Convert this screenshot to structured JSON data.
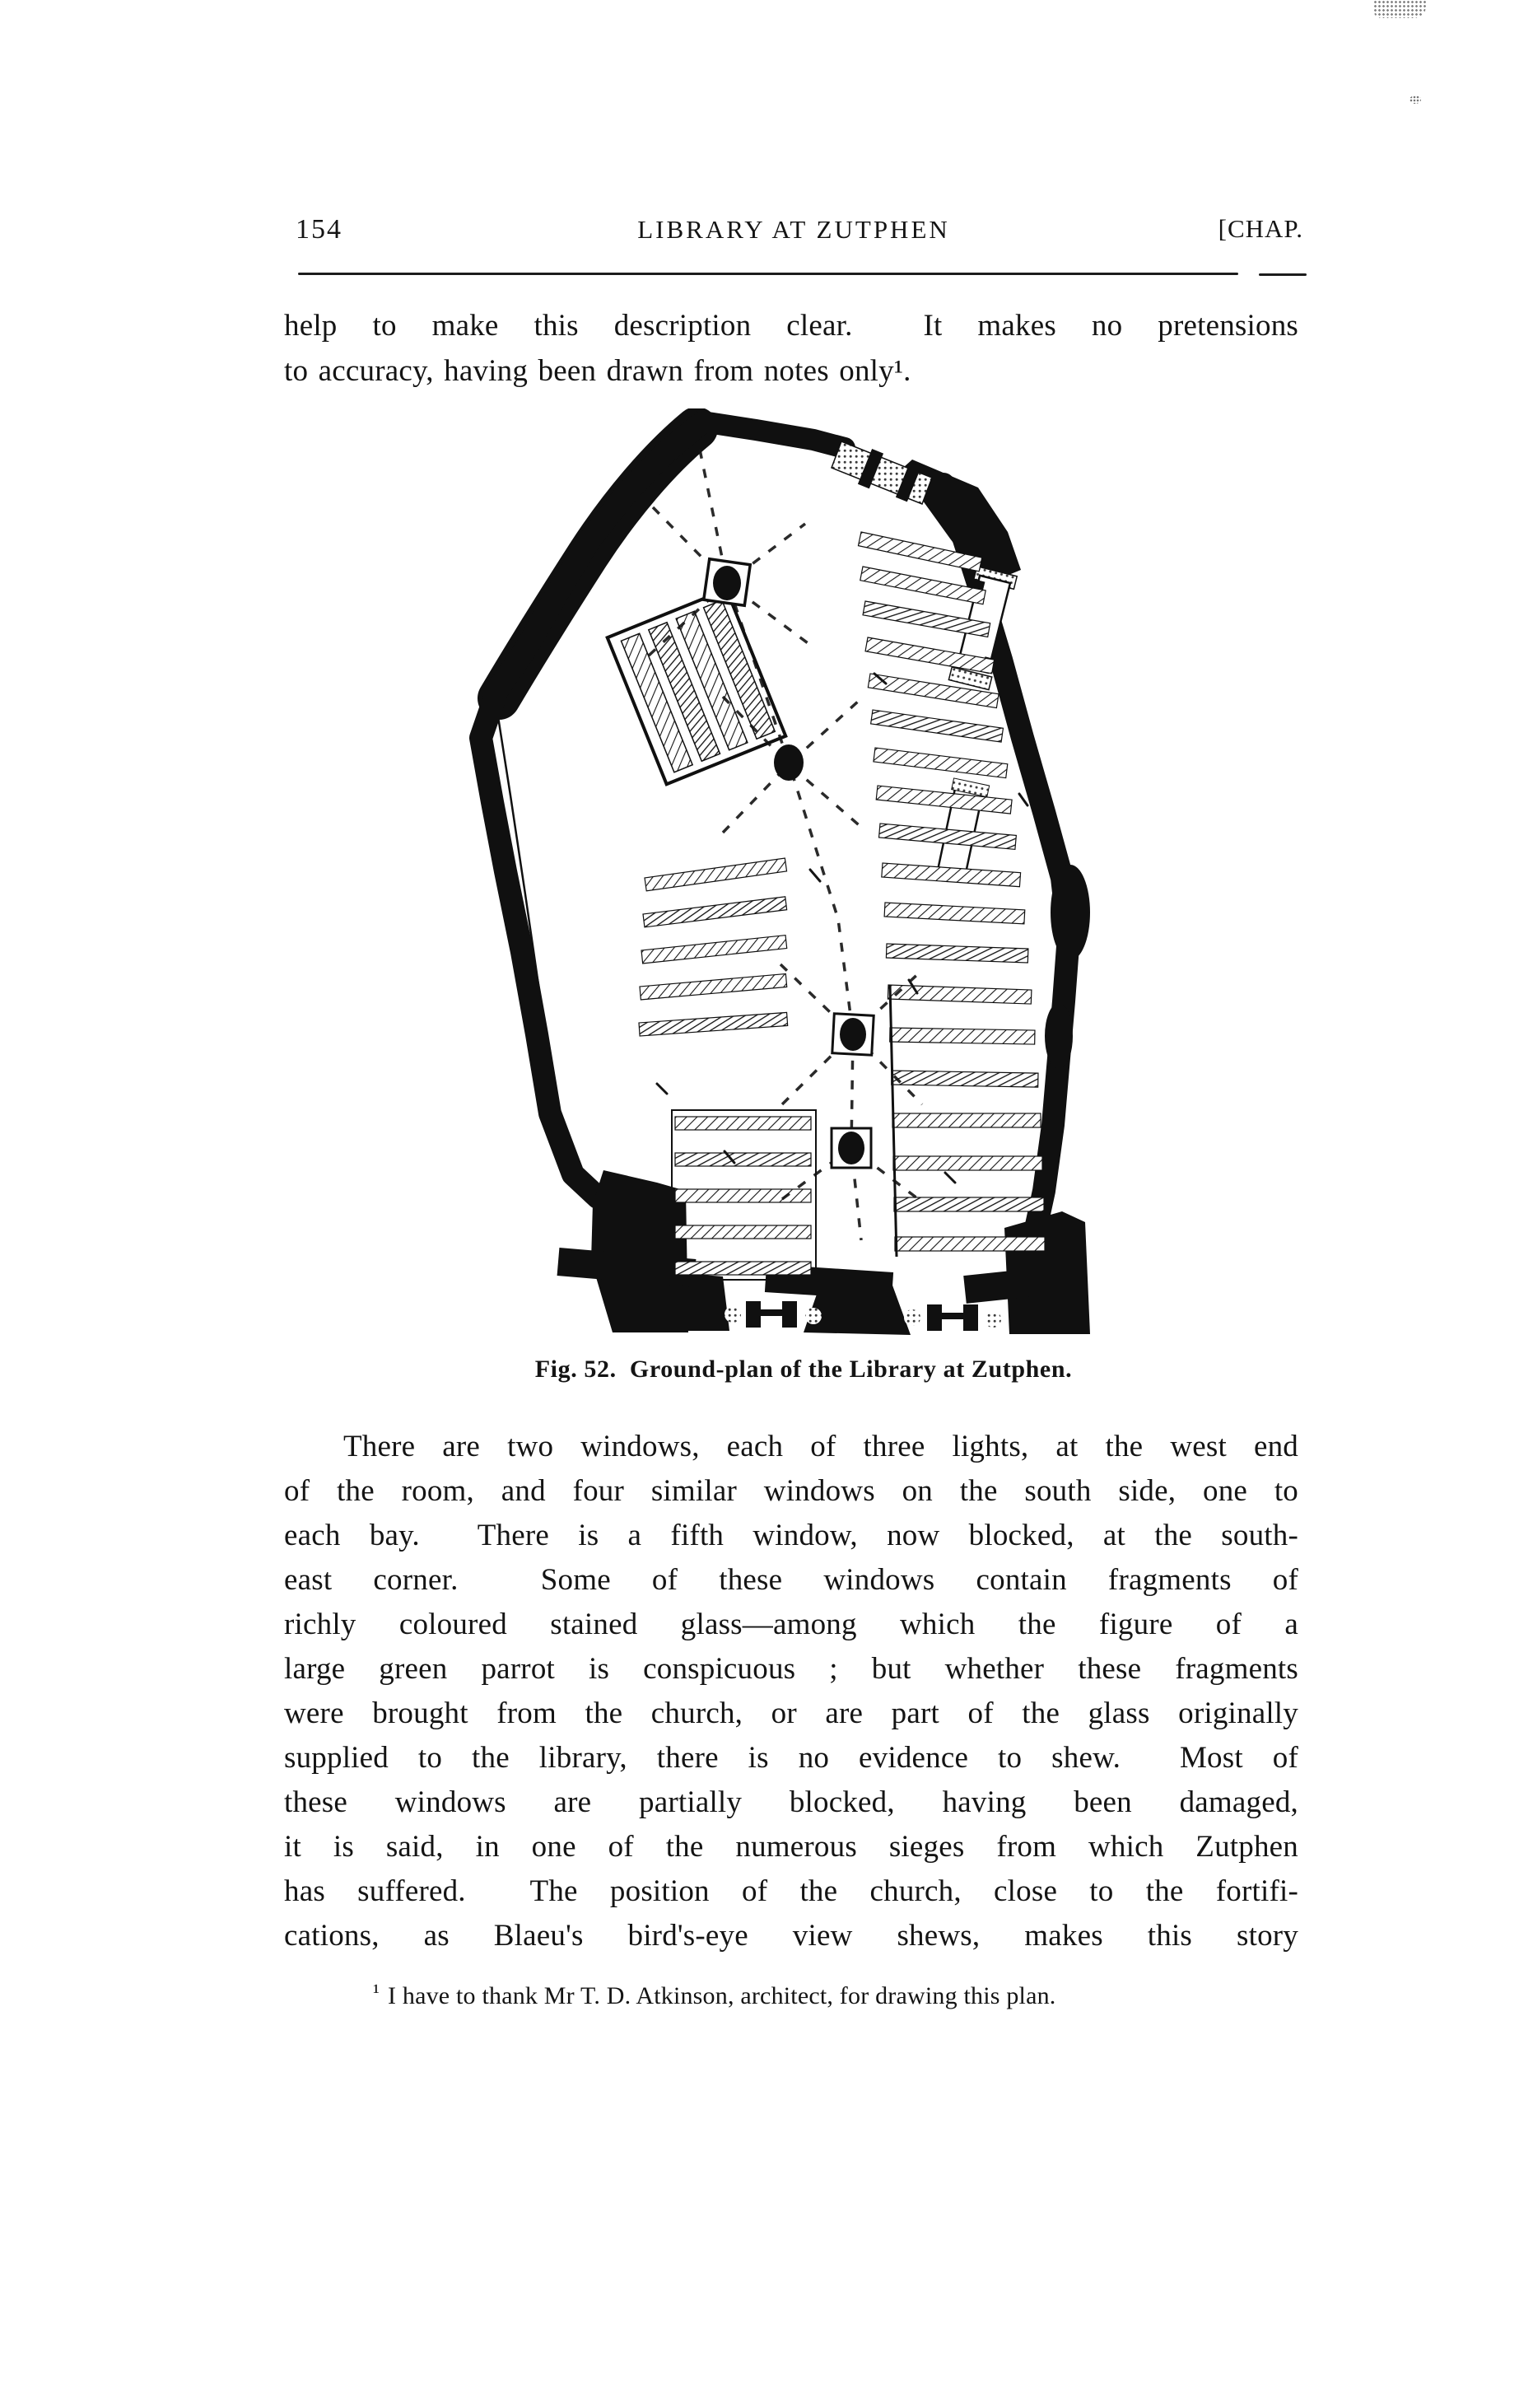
{
  "page_header": {
    "page_number": "154",
    "running_title": "LIBRARY AT ZUTPHEN",
    "chapter_marker": "[CHAP."
  },
  "intro_paragraph": {
    "lines": [
      "help to make this description clear.  It makes no pretensions",
      "to accuracy, having been drawn from notes only¹."
    ]
  },
  "figure": {
    "caption": "Fig. 52.  Ground-plan of the Library at Zutphen."
  },
  "body_paragraph": {
    "lines": [
      "There are two windows, each of three lights, at the west end",
      "of the room, and four similar windows on the south side, one to",
      "each bay.  There is a fifth window, now blocked, at the south-",
      "east corner.  Some of these windows contain fragments of",
      "richly coloured stained glass—among which the figure of a",
      "large green parrot is conspicuous ; but whether these fragments",
      "were brought from the church, or are part of the glass originally",
      "supplied to the library, there is no evidence to shew.  Most of",
      "these windows are partially blocked, having been damaged,",
      "it is said, in one of the numerous sieges from which Zutphen",
      "has suffered.  The position of the church, close to the fortifi-",
      "cations, as Blaeu's bird's-eye view shews, makes this story"
    ]
  },
  "footnote": {
    "marker": "¹",
    "text": "I have to thank Mr T. D. Atkinson, architect, for drawing this plan."
  },
  "ink_color": "#141414"
}
